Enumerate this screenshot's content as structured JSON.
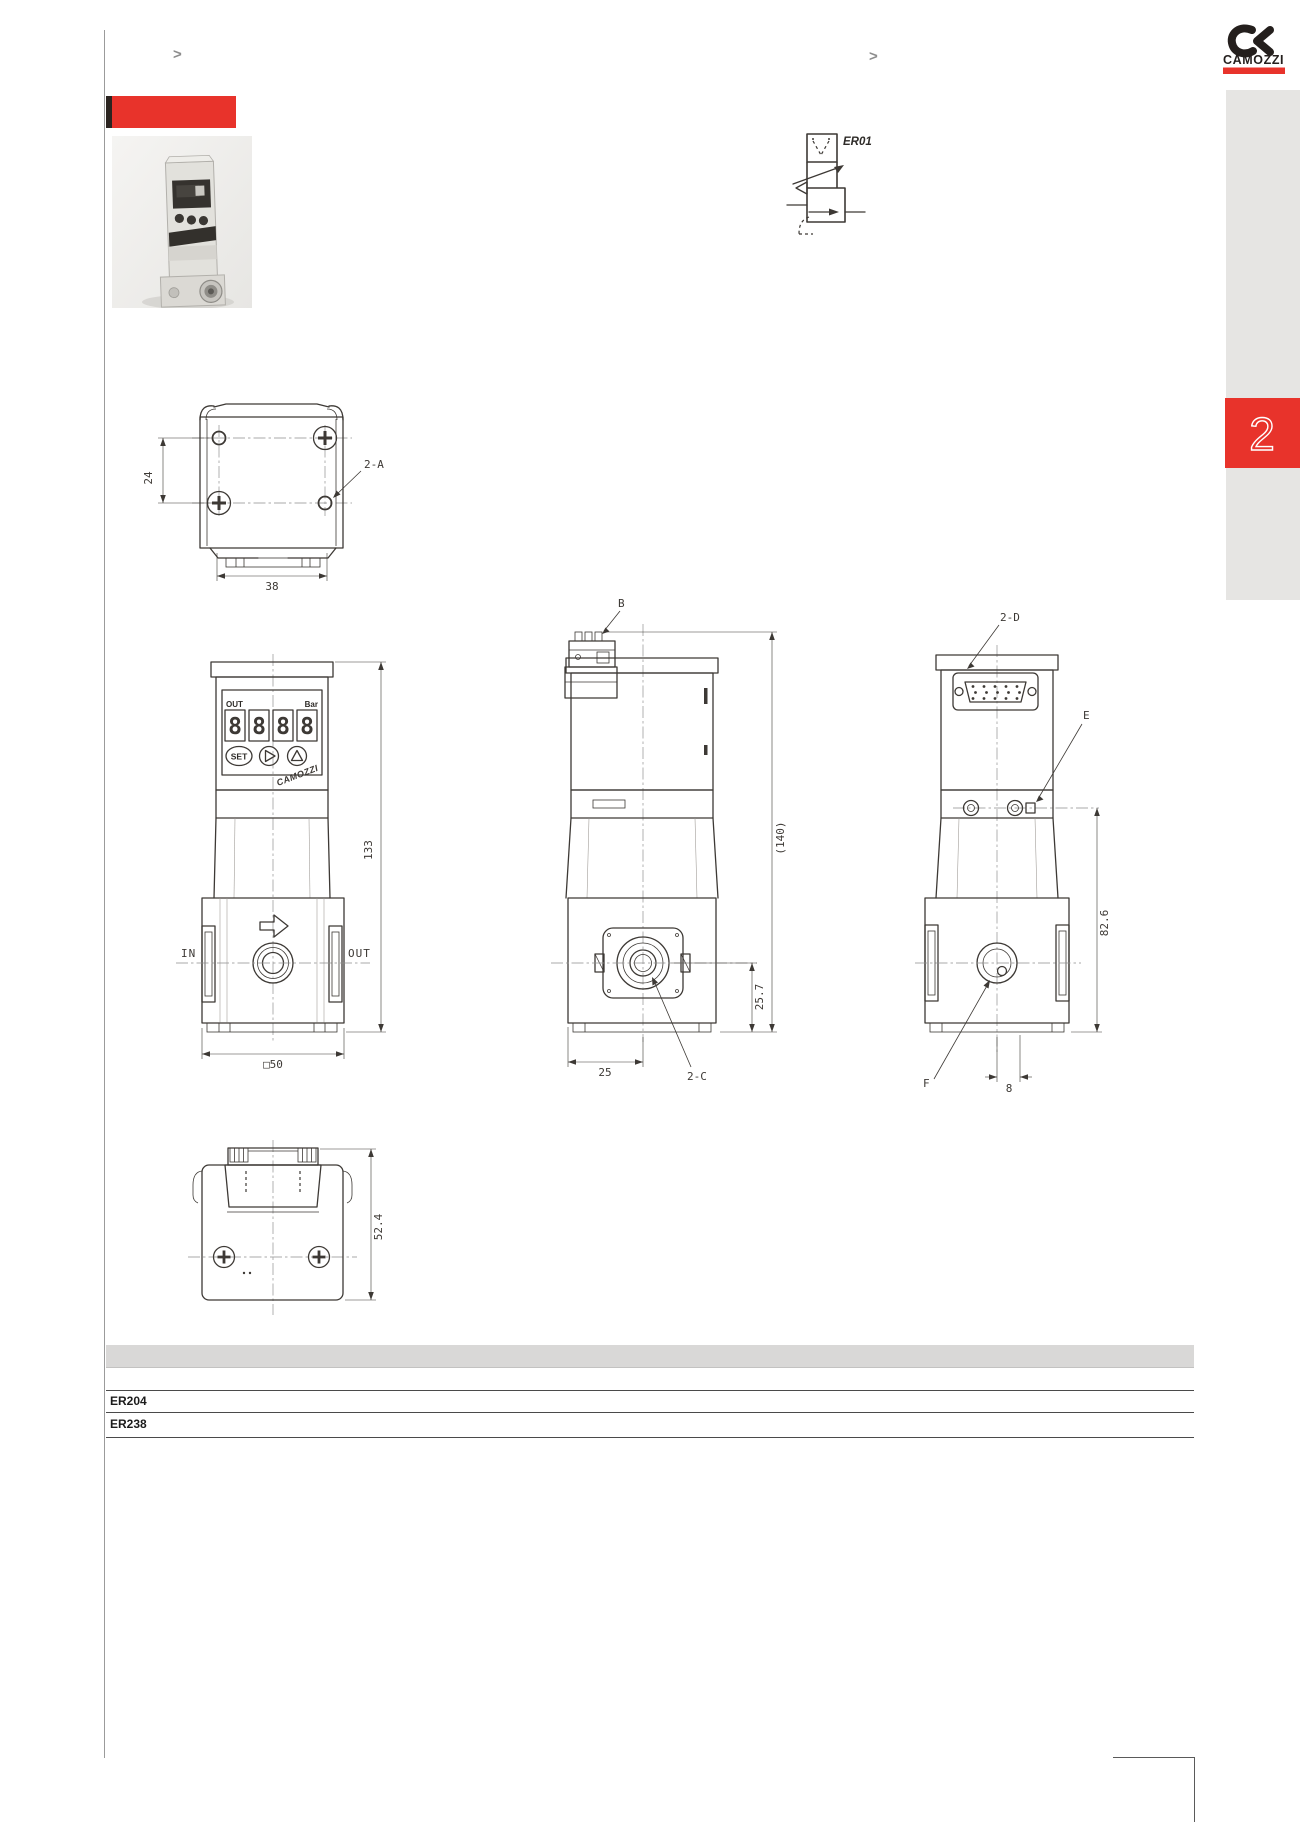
{
  "nav": {
    "chevron_left": ">",
    "chevron_right": ">",
    "section_tab": "2"
  },
  "brand": {
    "name": "CAMOZZI"
  },
  "schematic": {
    "model": "ER01"
  },
  "regulator_display": {
    "out": "OUT",
    "unit": "Bar",
    "digits": [
      "8",
      "8",
      "8",
      "8"
    ],
    "set": "SET",
    "brand": "CAMOZZI"
  },
  "views": {
    "top": {
      "dim_height": "24",
      "dim_width": "38",
      "callout": "2-A"
    },
    "front": {
      "port_in": "IN",
      "port_out": "OUT",
      "dim_height": "133",
      "dim_width": "□50"
    },
    "side": {
      "callout_top": "B",
      "dim_total_height": "(140)",
      "dim_port_height": "25.7",
      "dim_port_x": "25",
      "callout_port": "2-C"
    },
    "rear": {
      "callout_connector": "2-D",
      "callout_screw": "E",
      "dim_height": "82.6",
      "callout_port": "F",
      "dim_offset": "8"
    },
    "bottom": {
      "dim_depth": "52.4"
    }
  },
  "table": {
    "rows": [
      {
        "model": "ER204"
      },
      {
        "model": "ER238"
      }
    ]
  },
  "colors": {
    "accent": "#e8332b",
    "line": "#3d3935",
    "sidebar": "#e6e5e3"
  }
}
